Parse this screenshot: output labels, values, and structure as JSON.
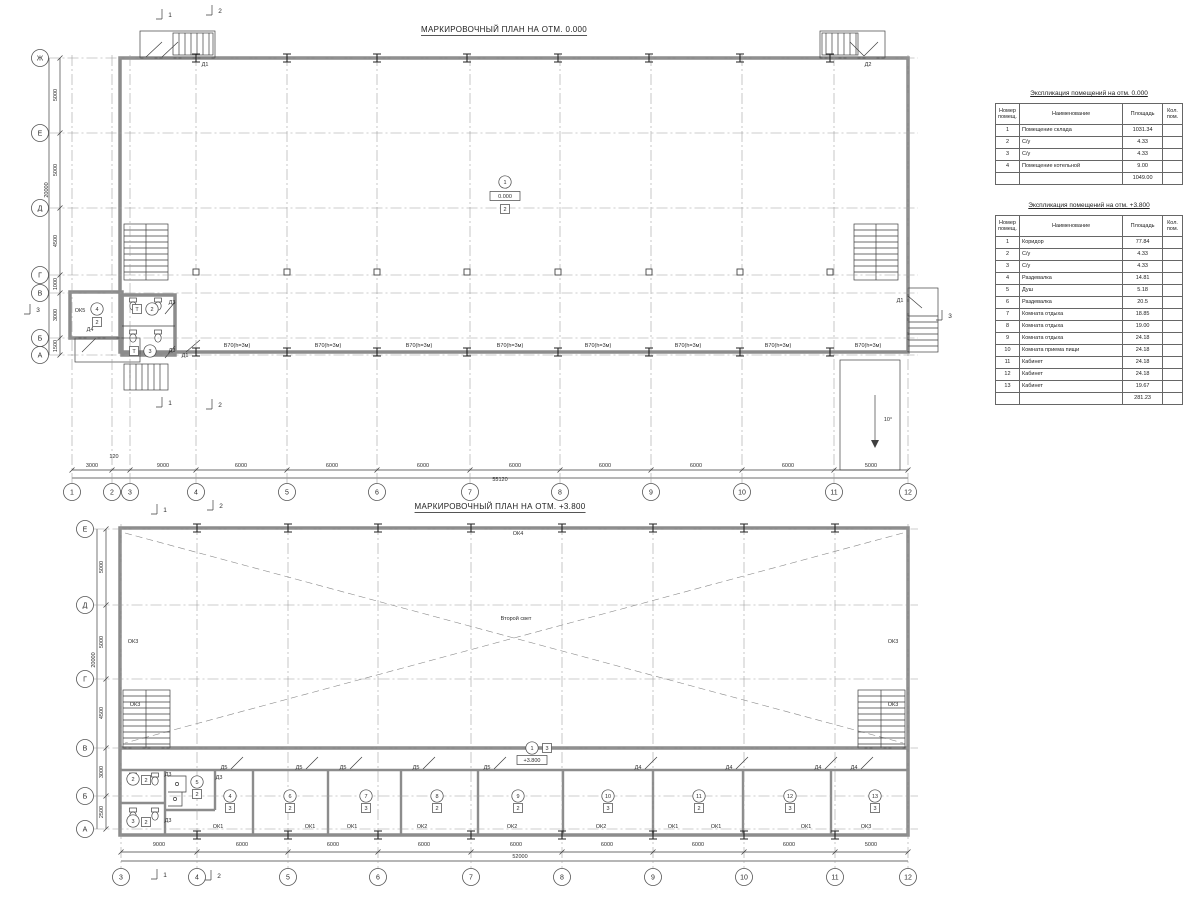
{
  "plan1": {
    "title": "МАРКИРОВОЧНЫЙ ПЛАН НА ОТМ. 0.000",
    "cols": {
      "items": [
        {
          "t": "1",
          "x": 72
        },
        {
          "t": "2",
          "x": 112
        },
        {
          "t": "3",
          "x": 130
        },
        {
          "t": "4",
          "x": 196
        },
        {
          "t": "5",
          "x": 287
        },
        {
          "t": "6",
          "x": 377
        },
        {
          "t": "7",
          "x": 470
        },
        {
          "t": "8",
          "x": 560
        },
        {
          "t": "9",
          "x": 651
        },
        {
          "t": "10",
          "x": 742
        },
        {
          "t": "11",
          "x": 834
        },
        {
          "t": "12",
          "x": 908
        }
      ]
    },
    "rows": {
      "items": [
        {
          "t": "Ж",
          "y": 58
        },
        {
          "t": "Е",
          "y": 133
        },
        {
          "t": "Д",
          "y": 208
        },
        {
          "t": "Г",
          "y": 275
        },
        {
          "t": "В",
          "y": 293
        },
        {
          "t": "Б",
          "y": 338
        },
        {
          "t": "А",
          "y": 355
        }
      ]
    },
    "dims": [
      {
        "t": "3000",
        "x": 92,
        "y": 467
      },
      {
        "t": "120",
        "x": 114,
        "y": 458
      },
      {
        "t": "9000",
        "x": 163,
        "y": 467
      },
      {
        "t": "6000",
        "x": 241,
        "y": 467
      },
      {
        "t": "6000",
        "x": 332,
        "y": 467
      },
      {
        "t": "6000",
        "x": 423,
        "y": 467
      },
      {
        "t": "6000",
        "x": 515,
        "y": 467
      },
      {
        "t": "6000",
        "x": 605,
        "y": 467
      },
      {
        "t": "6000",
        "x": 696,
        "y": 467
      },
      {
        "t": "6000",
        "x": 788,
        "y": 467
      },
      {
        "t": "5000",
        "x": 871,
        "y": 467
      },
      {
        "t": "55120",
        "x": 500,
        "y": 481
      },
      {
        "t": "5000",
        "x": 57,
        "y": 95,
        "r": 1
      },
      {
        "t": "5000",
        "x": 57,
        "y": 170,
        "r": 1
      },
      {
        "t": "4500",
        "x": 57,
        "y": 241,
        "r": 1
      },
      {
        "t": "1000",
        "x": 57,
        "y": 284,
        "r": 1
      },
      {
        "t": "3000",
        "x": 57,
        "y": 315,
        "r": 1
      },
      {
        "t": "1500",
        "x": 57,
        "y": 346,
        "r": 1
      },
      {
        "t": "20000",
        "x": 48,
        "y": 190,
        "r": 1
      }
    ],
    "texts": [
      {
        "k": "c",
        "t": "1",
        "x": 505,
        "y": 182
      },
      {
        "k": "l",
        "t": "0.000",
        "x": 505,
        "y": 196
      },
      {
        "k": "b",
        "t": "2",
        "x": 505,
        "y": 209
      },
      {
        "k": "c",
        "t": "4",
        "x": 97,
        "y": 309
      },
      {
        "k": "b",
        "t": "2",
        "x": 97,
        "y": 322
      },
      {
        "k": "p",
        "t": "ОК5",
        "x": 80,
        "y": 312
      },
      {
        "k": "b",
        "t": "Т",
        "x": 137,
        "y": 309
      },
      {
        "k": "c",
        "t": "2",
        "x": 152,
        "y": 309
      },
      {
        "k": "b",
        "t": "Т",
        "x": 134,
        "y": 351
      },
      {
        "k": "c",
        "t": "3",
        "x": 150,
        "y": 351
      },
      {
        "k": "p",
        "t": "Д1",
        "x": 205,
        "y": 66
      },
      {
        "k": "p",
        "t": "Д2",
        "x": 868,
        "y": 66
      },
      {
        "k": "p",
        "t": "Д1",
        "x": 900,
        "y": 302
      },
      {
        "k": "p",
        "t": "Д3",
        "x": 172,
        "y": 304
      },
      {
        "k": "p",
        "t": "Д3",
        "x": 172,
        "y": 352
      },
      {
        "k": "p",
        "t": "Д4",
        "x": 90,
        "y": 331
      },
      {
        "k": "p",
        "t": "Д1",
        "x": 185,
        "y": 357
      },
      {
        "k": "m",
        "t": "1",
        "x": 170,
        "y": 17
      },
      {
        "k": "m",
        "t": "2",
        "x": 220,
        "y": 13
      },
      {
        "k": "m",
        "t": "1",
        "x": 170,
        "y": 405
      },
      {
        "k": "m",
        "t": "2",
        "x": 220,
        "y": 407
      },
      {
        "k": "m",
        "t": "3",
        "x": 950,
        "y": 318
      },
      {
        "k": "m",
        "t": "3",
        "x": 38,
        "y": 312
      },
      {
        "k": "p",
        "t": "10°",
        "x": 888,
        "y": 421
      },
      {
        "k": "p",
        "t": "В70(h=3м)",
        "x": 237,
        "y": 347
      },
      {
        "k": "p",
        "t": "В70(h=3м)",
        "x": 328,
        "y": 347
      },
      {
        "k": "p",
        "t": "В70(h=3м)",
        "x": 419,
        "y": 347
      },
      {
        "k": "p",
        "t": "В70(h=3м)",
        "x": 510,
        "y": 347
      },
      {
        "k": "p",
        "t": "В70(h=3м)",
        "x": 598,
        "y": 347
      },
      {
        "k": "p",
        "t": "В70(h=3м)",
        "x": 688,
        "y": 347
      },
      {
        "k": "p",
        "t": "В70(h=3м)",
        "x": 778,
        "y": 347
      },
      {
        "k": "p",
        "t": "В70(h=3м)",
        "x": 868,
        "y": 347
      }
    ]
  },
  "plan2": {
    "title": "МАРКИРОВОЧНЫЙ ПЛАН НА ОТМ. +3.800",
    "cols": {
      "items": [
        {
          "t": "3",
          "x": 121
        },
        {
          "t": "4",
          "x": 197
        },
        {
          "t": "5",
          "x": 288
        },
        {
          "t": "6",
          "x": 378
        },
        {
          "t": "7",
          "x": 471
        },
        {
          "t": "8",
          "x": 562
        },
        {
          "t": "9",
          "x": 653
        },
        {
          "t": "10",
          "x": 744
        },
        {
          "t": "11",
          "x": 835
        },
        {
          "t": "12",
          "x": 908
        }
      ]
    },
    "rows": {
      "items": [
        {
          "t": "Е",
          "y": 529
        },
        {
          "t": "Д",
          "y": 605
        },
        {
          "t": "Г",
          "y": 679
        },
        {
          "t": "В",
          "y": 748
        },
        {
          "t": "Б",
          "y": 796
        },
        {
          "t": "А",
          "y": 829
        }
      ]
    },
    "dims": [
      {
        "t": "9000",
        "x": 159,
        "y": 846
      },
      {
        "t": "6000",
        "x": 242,
        "y": 846
      },
      {
        "t": "6000",
        "x": 333,
        "y": 846
      },
      {
        "t": "6000",
        "x": 424,
        "y": 846
      },
      {
        "t": "6000",
        "x": 516,
        "y": 846
      },
      {
        "t": "6000",
        "x": 607,
        "y": 846
      },
      {
        "t": "6000",
        "x": 698,
        "y": 846
      },
      {
        "t": "6000",
        "x": 789,
        "y": 846
      },
      {
        "t": "5000",
        "x": 871,
        "y": 846
      },
      {
        "t": "52000",
        "x": 520,
        "y": 858
      },
      {
        "t": "5000",
        "x": 103,
        "y": 567,
        "r": 1
      },
      {
        "t": "5000",
        "x": 103,
        "y": 642,
        "r": 1
      },
      {
        "t": "4500",
        "x": 103,
        "y": 713,
        "r": 1
      },
      {
        "t": "3000",
        "x": 103,
        "y": 772,
        "r": 1
      },
      {
        "t": "2500",
        "x": 103,
        "y": 812,
        "r": 1
      },
      {
        "t": "20000",
        "x": 95,
        "y": 660,
        "r": 1
      }
    ],
    "texts": [
      {
        "k": "p",
        "t": "Второй свет",
        "x": 516,
        "y": 620
      },
      {
        "k": "p",
        "t": "ОК4",
        "x": 518,
        "y": 535
      },
      {
        "k": "p",
        "t": "ОК3",
        "x": 133,
        "y": 643
      },
      {
        "k": "p",
        "t": "ОК3",
        "x": 135,
        "y": 706
      },
      {
        "k": "p",
        "t": "ОК3",
        "x": 893,
        "y": 643
      },
      {
        "k": "p",
        "t": "ОК3",
        "x": 893,
        "y": 706
      },
      {
        "k": "c",
        "t": "1",
        "x": 532,
        "y": 748
      },
      {
        "k": "b",
        "t": "3",
        "x": 547,
        "y": 748
      },
      {
        "k": "l",
        "t": "+3.800",
        "x": 532,
        "y": 760
      },
      {
        "k": "c",
        "t": "2",
        "x": 133,
        "y": 779
      },
      {
        "k": "b",
        "t": "2",
        "x": 146,
        "y": 780
      },
      {
        "k": "c",
        "t": "3",
        "x": 133,
        "y": 821
      },
      {
        "k": "b",
        "t": "2",
        "x": 146,
        "y": 822
      },
      {
        "k": "c",
        "t": "5",
        "x": 197,
        "y": 782
      },
      {
        "k": "b",
        "t": "2",
        "x": 197,
        "y": 794
      },
      {
        "k": "c",
        "t": "4",
        "x": 230,
        "y": 796
      },
      {
        "k": "b",
        "t": "3",
        "x": 230,
        "y": 808
      },
      {
        "k": "c",
        "t": "6",
        "x": 290,
        "y": 796
      },
      {
        "k": "b",
        "t": "2",
        "x": 290,
        "y": 808
      },
      {
        "k": "c",
        "t": "7",
        "x": 366,
        "y": 796
      },
      {
        "k": "b",
        "t": "3",
        "x": 366,
        "y": 808
      },
      {
        "k": "c",
        "t": "8",
        "x": 437,
        "y": 796
      },
      {
        "k": "b",
        "t": "2",
        "x": 437,
        "y": 808
      },
      {
        "k": "c",
        "t": "9",
        "x": 518,
        "y": 796
      },
      {
        "k": "b",
        "t": "2",
        "x": 518,
        "y": 808
      },
      {
        "k": "c",
        "t": "10",
        "x": 608,
        "y": 796
      },
      {
        "k": "b",
        "t": "3",
        "x": 608,
        "y": 808
      },
      {
        "k": "c",
        "t": "11",
        "x": 699,
        "y": 796
      },
      {
        "k": "b",
        "t": "2",
        "x": 699,
        "y": 808
      },
      {
        "k": "c",
        "t": "12",
        "x": 790,
        "y": 796
      },
      {
        "k": "b",
        "t": "3",
        "x": 790,
        "y": 808
      },
      {
        "k": "c",
        "t": "13",
        "x": 875,
        "y": 796
      },
      {
        "k": "b",
        "t": "3",
        "x": 875,
        "y": 808
      },
      {
        "k": "p",
        "t": "Д3",
        "x": 168,
        "y": 776
      },
      {
        "k": "p",
        "t": "Д3",
        "x": 219,
        "y": 779
      },
      {
        "k": "p",
        "t": "Д3",
        "x": 168,
        "y": 822
      },
      {
        "k": "p",
        "t": "Д5",
        "x": 224,
        "y": 769,
        "dd": 1
      },
      {
        "k": "p",
        "t": "Д5",
        "x": 299,
        "y": 769,
        "dd": 1
      },
      {
        "k": "p",
        "t": "Д5",
        "x": 343,
        "y": 769,
        "dd": 1
      },
      {
        "k": "p",
        "t": "Д5",
        "x": 416,
        "y": 769,
        "dd": 1
      },
      {
        "k": "p",
        "t": "Д5",
        "x": 487,
        "y": 769,
        "dd": 1
      },
      {
        "k": "p",
        "t": "Д4",
        "x": 638,
        "y": 769,
        "dd": 1
      },
      {
        "k": "p",
        "t": "Д4",
        "x": 729,
        "y": 769,
        "dd": 1
      },
      {
        "k": "p",
        "t": "Д4",
        "x": 818,
        "y": 769,
        "dd": 1
      },
      {
        "k": "p",
        "t": "Д4",
        "x": 854,
        "y": 769,
        "dd": 1
      },
      {
        "k": "p",
        "t": "ОК1",
        "x": 218,
        "y": 828
      },
      {
        "k": "p",
        "t": "ОК1",
        "x": 310,
        "y": 828
      },
      {
        "k": "p",
        "t": "ОК1",
        "x": 352,
        "y": 828
      },
      {
        "k": "p",
        "t": "ОК2",
        "x": 422,
        "y": 828
      },
      {
        "k": "p",
        "t": "ОК2",
        "x": 512,
        "y": 828
      },
      {
        "k": "p",
        "t": "ОК2",
        "x": 601,
        "y": 828
      },
      {
        "k": "p",
        "t": "ОК1",
        "x": 673,
        "y": 828
      },
      {
        "k": "p",
        "t": "ОК1",
        "x": 716,
        "y": 828
      },
      {
        "k": "p",
        "t": "ОК1",
        "x": 806,
        "y": 828
      },
      {
        "k": "p",
        "t": "ОК3",
        "x": 866,
        "y": 828
      },
      {
        "k": "m",
        "t": "1",
        "x": 165,
        "y": 512
      },
      {
        "k": "m",
        "t": "2",
        "x": 221,
        "y": 508
      },
      {
        "k": "m",
        "t": "1",
        "x": 165,
        "y": 877
      },
      {
        "k": "m",
        "t": "2",
        "x": 219,
        "y": 878
      }
    ]
  },
  "tables": [
    {
      "title": "Экспликация помещений на отм. 0.000",
      "headers": [
        "Номер\nпомещ.",
        "Наименование",
        "Площадь",
        "Кол.\nпом."
      ],
      "rows": [
        [
          "1",
          "Помещение склада",
          "1031.34",
          ""
        ],
        [
          "2",
          "С/у",
          "4.33",
          ""
        ],
        [
          "3",
          "С/у",
          "4.33",
          ""
        ],
        [
          "4",
          "Помещение котельной",
          "9.00",
          ""
        ]
      ],
      "total": "1049.00"
    },
    {
      "title": "Экспликация помещений на отм. +3.800",
      "headers": [
        "Номер\nпомещ.",
        "Наименование",
        "Площадь",
        "Кол.\nпом."
      ],
      "rows": [
        [
          "1",
          "Коридор",
          "77.84",
          ""
        ],
        [
          "2",
          "С/у",
          "4.33",
          ""
        ],
        [
          "3",
          "С/у",
          "4.33",
          ""
        ],
        [
          "4",
          "Раздевалка",
          "14.81",
          ""
        ],
        [
          "5",
          "Душ",
          "5.18",
          ""
        ],
        [
          "6",
          "Раздевалка",
          "20.5",
          ""
        ],
        [
          "7",
          "Комната отдыха",
          "18.85",
          ""
        ],
        [
          "8",
          "Комната отдыха",
          "19.00",
          ""
        ],
        [
          "9",
          "Комната отдыха",
          "24.18",
          ""
        ],
        [
          "10",
          "Комната приема пищи",
          "24.18",
          ""
        ],
        [
          "11",
          "Кабинет",
          "24.18",
          ""
        ],
        [
          "12",
          "Кабинет",
          "24.18",
          ""
        ],
        [
          "13",
          "Кабинет",
          "19.67",
          ""
        ]
      ],
      "total": "281.23"
    }
  ]
}
